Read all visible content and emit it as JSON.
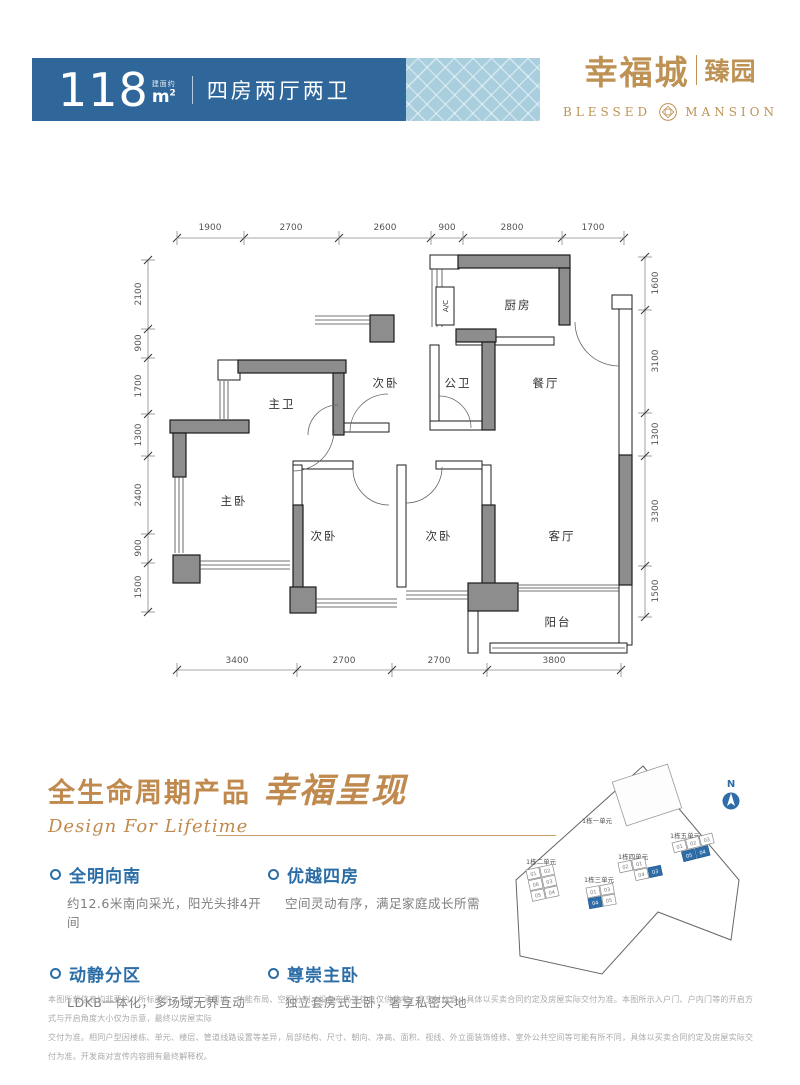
{
  "banner": {
    "area_value": "118",
    "area_prefix": "建面约",
    "area_unit": "m",
    "area_sup": "2",
    "layout": "四房两厅两卫"
  },
  "logo": {
    "cn_main": "幸福城",
    "cn_sub": "臻园",
    "en_left": "BLESSED",
    "en_right": "MANSION"
  },
  "plan": {
    "dims_top": [
      "1900",
      "2700",
      "2600",
      "900",
      "2800",
      "1700"
    ],
    "dims_left": [
      "2100",
      "900",
      "1700",
      "1300",
      "2400",
      "900",
      "1500"
    ],
    "dims_right": [
      "1600",
      "3100",
      "1300",
      "3300",
      "1500"
    ],
    "dims_bottom": [
      "3400",
      "2700",
      "2700",
      "3800"
    ],
    "rooms": {
      "master_bath": "主卫",
      "bedroom_top": "次卧",
      "public_bath": "公卫",
      "kitchen": "厨房",
      "dining": "餐厅",
      "master_bedroom": "主卧",
      "bedroom_left": "次卧",
      "bedroom_mid": "次卧",
      "living": "客厅",
      "balcony": "阳台",
      "ac": "A/C"
    }
  },
  "headline": {
    "cn": "全生命周期产品",
    "calligraphy": "幸福呈现",
    "en": "Design For Lifetime"
  },
  "features": [
    {
      "title": "全明向南",
      "desc": "约12.6米南向采光，阳光头排4开间"
    },
    {
      "title": "优越四房",
      "desc": "空间灵动有序，满足家庭成长所需"
    },
    {
      "title": "动静分区",
      "desc": "LDKB一体化，多场域无界互动"
    },
    {
      "title": "尊崇主卧",
      "desc": "独立套房式主卧，奢享私密天地"
    }
  ],
  "siteplan": {
    "compass": "N",
    "building_one_label": "1栋一单元",
    "clusters": [
      {
        "label": "1栋二单元",
        "units": [
          "01",
          "02",
          "06",
          "03",
          "05",
          "04"
        ]
      },
      {
        "label": "1栋三单元",
        "units": [
          "01",
          "03",
          "05",
          "04"
        ]
      },
      {
        "label": "1栋四单元",
        "units": [
          "02",
          "01",
          "04",
          "03"
        ]
      },
      {
        "label": "1栋五单元",
        "units": [
          "01",
          "02",
          "03",
          "05",
          "04"
        ]
      }
    ]
  },
  "disclaimer": {
    "line1": "本图所载信息均非要约，所标面积、尺寸、承重墙、功能布局、空间分割、设备布局等信息仅供参考，非交付标准，具体以买卖合同约定及房屋实际交付为准。本图所示入户门、户内门等的开启方式与开启角度大小仅为示意，最终以房屋实际",
    "line2": "交付为准。相同户型因楼栋、单元、楼层、管道线路设置等差异，局部结构、尺寸、朝向、净高、面积、视线、外立面装饰维修、室外公共空间等可能有所不同，具体以买卖合同约定及房屋实际交付为准。开发商对宣传内容拥有最终解释权。"
  },
  "colors": {
    "banner_blue": "#30679a",
    "banner_light_blue": "#a9cfdf",
    "accent_gold": "#bd9254",
    "feature_blue": "#2b6ea7",
    "wall_gray": "#8d8d8d"
  }
}
